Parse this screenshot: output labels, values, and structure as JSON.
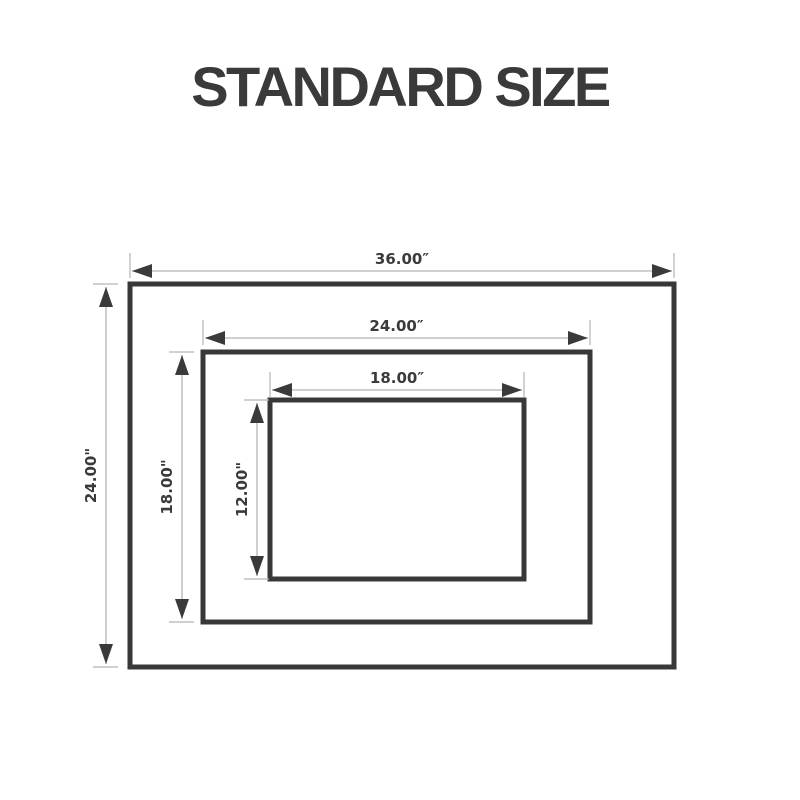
{
  "title": "STANDARD SIZE",
  "colors": {
    "background": "#ffffff",
    "text": "#3a3a3a",
    "rect_stroke": "#383838",
    "rect_fill": "#ffffff",
    "dim_line": "#b3b3b3",
    "arrow_fill": "#3a3a3a"
  },
  "diagram": {
    "rects": [
      {
        "name": "outer",
        "width_label": "36.00″",
        "height_label": "24.00\"",
        "width_inches": 36.0,
        "height_inches": 24.0,
        "x": 130,
        "y": 284,
        "w": 544,
        "h": 383,
        "dim_top": 13,
        "dim_left": 24
      },
      {
        "name": "middle",
        "width_label": "24.00″",
        "height_label": "18.00\"",
        "width_inches": 24.0,
        "height_inches": 18.0,
        "x": 203,
        "y": 352,
        "w": 387,
        "h": 270,
        "dim_top": 14,
        "dim_left": 21
      },
      {
        "name": "inner",
        "width_label": "18.00″",
        "height_label": "12.00\"",
        "width_inches": 18.0,
        "height_inches": 12.0,
        "x": 270,
        "y": 400,
        "w": 254,
        "h": 179,
        "dim_top": 10,
        "dim_left": 13
      }
    ]
  }
}
